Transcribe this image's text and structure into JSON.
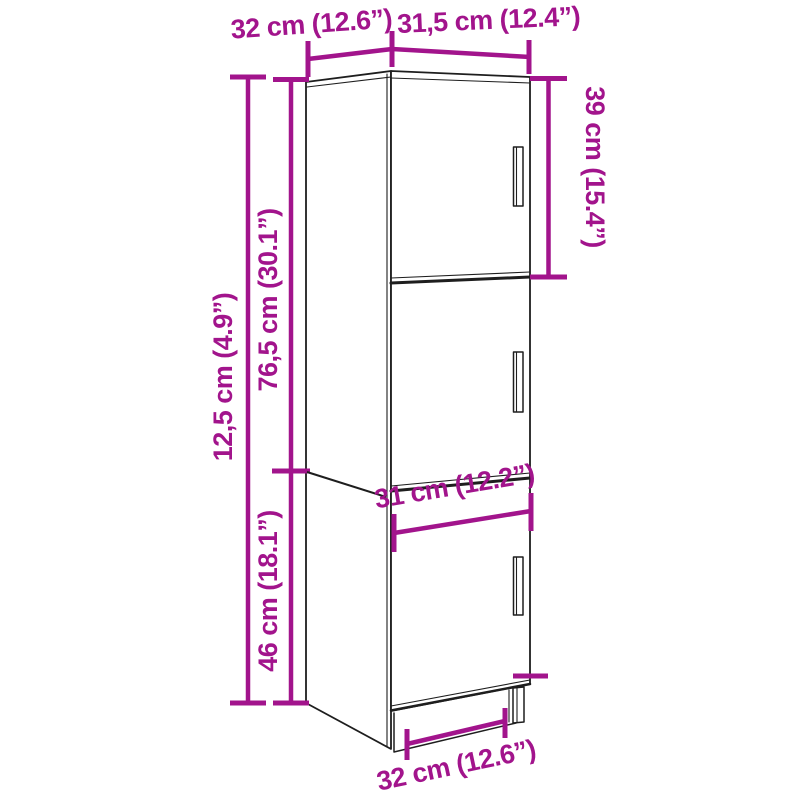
{
  "subject": "tall-cabinet-3-doors-dimension-diagram",
  "colors": {
    "dimension_magenta": "#A2148C",
    "cabinet_outline": "#1E1E1E",
    "background": "#FFFFFF"
  },
  "annotations": {
    "top_width": "32 cm (12.6”)",
    "top_depth": "31,5 cm (12.4”)",
    "right_section": "39 cm (15.4”)",
    "left_outer": "12,5 cm (4.9”)",
    "left_upper": "76,5 cm (30.1”)",
    "left_lower": "46 cm (18.1”)",
    "inner_width": "31 cm (12.2”)",
    "bottom_width": "32 cm (12.6”)"
  }
}
